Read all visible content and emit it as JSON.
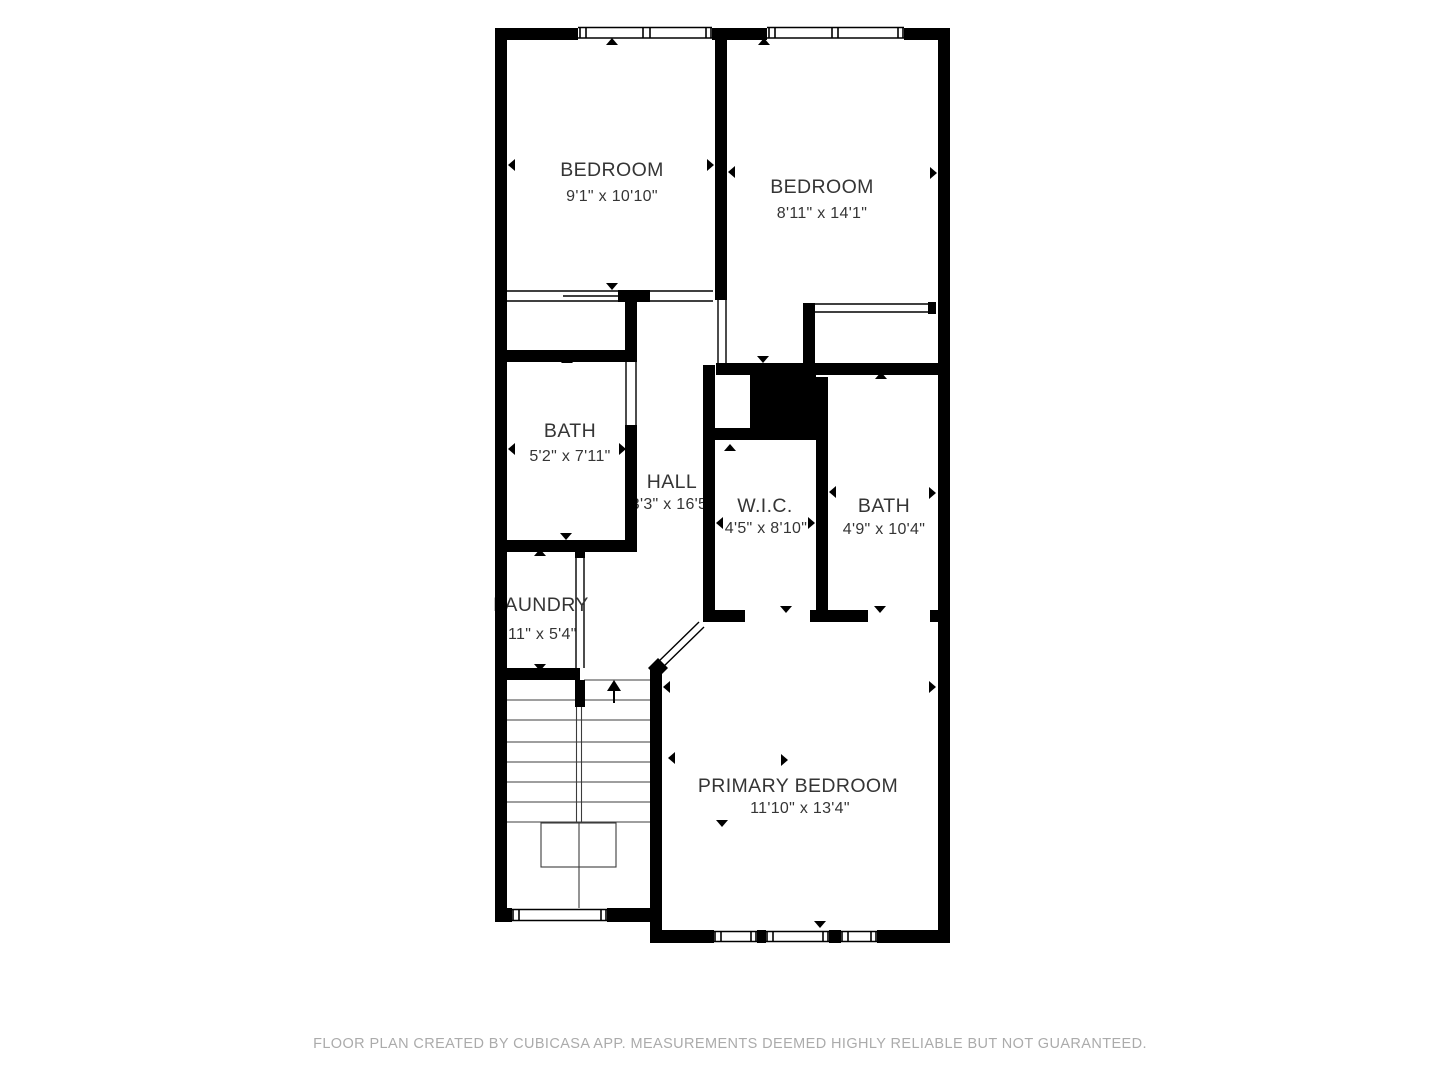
{
  "floor_plan": {
    "source_note": "FLOOR PLAN CREATED BY CUBICASA APP. MEASUREMENTS DEEMED HIGHLY RELIABLE BUT NOT GUARANTEED.",
    "colors": {
      "wall": "#000000",
      "label": "#353535",
      "footer": "#ababab",
      "background": "#ffffff"
    },
    "rooms": [
      {
        "name": "BEDROOM",
        "dims": "9'1\" x 10'10\""
      },
      {
        "name": "BEDROOM",
        "dims": "8'11\" x 14'1\""
      },
      {
        "name": "BATH",
        "dims": "5'2\" x 7'11\""
      },
      {
        "name": "HALL",
        "dims": "3'3\" x 16'5\""
      },
      {
        "name": "W.I.C.",
        "dims": "4'5\" x 8'10\""
      },
      {
        "name": "BATH",
        "dims": "4'9\" x 10'4\""
      },
      {
        "name": "LAUNDRY",
        "dims": "11\" x 5'4\""
      },
      {
        "name": "PRIMARY BEDROOM",
        "dims": "11'10\" x 13'4\""
      }
    ],
    "features": [
      "stairs-up",
      "windows",
      "door-openings",
      "sliding-closet-doors",
      "diagonal-entry-door",
      "utility-shaft"
    ]
  }
}
